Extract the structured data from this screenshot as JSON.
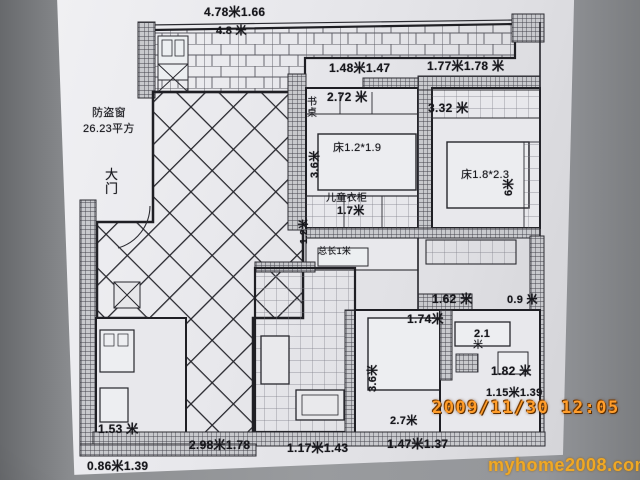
{
  "photo": {
    "datestamp": "2009/11/30 12:05",
    "watermark": "myhome2008.com"
  },
  "colors": {
    "datestamp": "#ff9d2b",
    "watermark": "#f0a824",
    "ink": "#1c1c22",
    "paper": "#e6e6ea",
    "background": "#8d8f92"
  },
  "plan": {
    "annotations": [
      {
        "name": "dim-balcony-top",
        "text": "4.78米1.66",
        "x": 204,
        "y": 6,
        "size": 12,
        "bold": true
      },
      {
        "name": "dim-balcony-inner",
        "text": "4.8 米",
        "x": 216,
        "y": 26,
        "size": 11,
        "bold": true
      },
      {
        "name": "dim-child-window",
        "text": "1.48米1.47",
        "x": 329,
        "y": 62,
        "size": 12,
        "bold": true
      },
      {
        "name": "dim-master-window",
        "text": "1.77米1.78 米",
        "x": 427,
        "y": 60,
        "size": 12,
        "bold": true
      },
      {
        "name": "dim-child-width",
        "text": "2.72 米",
        "x": 327,
        "y": 91,
        "size": 12,
        "bold": true
      },
      {
        "name": "label-desk",
        "text": "书桌",
        "x": 307,
        "y": 98,
        "size": 10,
        "stack": true
      },
      {
        "name": "dim-master-width",
        "text": "3.32 米",
        "x": 428,
        "y": 102,
        "size": 12,
        "bold": true
      },
      {
        "name": "label-child-bed",
        "text": "床1.2*1.9",
        "x": 333,
        "y": 143,
        "size": 11
      },
      {
        "name": "dim-child-depth",
        "text": "3.6米",
        "x": 310,
        "y": 178,
        "size": 11,
        "bold": true,
        "rot": -90
      },
      {
        "name": "label-child-wardrobe",
        "text": "儿童衣柜",
        "x": 326,
        "y": 194,
        "size": 10
      },
      {
        "name": "dim-wardrobe",
        "text": "1.7米",
        "x": 337,
        "y": 206,
        "size": 11,
        "bold": true
      },
      {
        "name": "label-master-bed",
        "text": "床1.8*2.3",
        "x": 461,
        "y": 170,
        "size": 11
      },
      {
        "name": "dim-master-depth",
        "text": "6米",
        "x": 504,
        "y": 196,
        "size": 11,
        "bold": true,
        "rot": -90
      },
      {
        "name": "note-security-window-1",
        "text": "防盗窗",
        "x": 92,
        "y": 108,
        "size": 11
      },
      {
        "name": "note-security-window-2",
        "text": "26.23平方",
        "x": 83,
        "y": 124,
        "size": 11
      },
      {
        "name": "label-main-door",
        "text": "大门",
        "x": 105,
        "y": 168,
        "size": 13,
        "stack": true
      },
      {
        "name": "dim-hall",
        "text": "1.2米",
        "x": 300,
        "y": 244,
        "size": 10,
        "bold": true,
        "rot": -90
      },
      {
        "name": "note-total-length",
        "text": "总长1米",
        "x": 318,
        "y": 247,
        "size": 9
      },
      {
        "name": "dim-kitchen",
        "text": "1.62 米",
        "x": 432,
        "y": 293,
        "size": 12,
        "bold": true
      },
      {
        "name": "dim-kitchen-right",
        "text": "0.9 米",
        "x": 507,
        "y": 295,
        "size": 11,
        "bold": true
      },
      {
        "name": "dim-passage",
        "text": "1.74米",
        "x": 407,
        "y": 313,
        "size": 12,
        "bold": true
      },
      {
        "name": "dim-room-21",
        "text": "2.1",
        "x": 474,
        "y": 329,
        "size": 11,
        "bold": true
      },
      {
        "name": "dim-room-21-unit",
        "text": "米",
        "x": 473,
        "y": 341,
        "size": 10
      },
      {
        "name": "dim-room-182",
        "text": "1.82 米",
        "x": 491,
        "y": 365,
        "size": 12,
        "bold": true
      },
      {
        "name": "dim-room-115",
        "text": "1.15米1.39",
        "x": 486,
        "y": 388,
        "size": 11,
        "bold": true
      },
      {
        "name": "dim-dining-depth",
        "text": "3.6米",
        "x": 368,
        "y": 392,
        "size": 11,
        "bold": true,
        "rot": -90
      },
      {
        "name": "dim-dining",
        "text": "2.7米",
        "x": 390,
        "y": 416,
        "size": 11,
        "bold": true
      },
      {
        "name": "dim-dining-bottom",
        "text": "1.47米1.37",
        "x": 387,
        "y": 438,
        "size": 12,
        "bold": true
      },
      {
        "name": "dim-bath-bottom",
        "text": "1.17米1.43",
        "x": 287,
        "y": 442,
        "size": 12,
        "bold": true
      },
      {
        "name": "dim-living-bottom",
        "text": "2.98米1.78",
        "x": 189,
        "y": 439,
        "size": 12,
        "bold": true
      },
      {
        "name": "dim-left-room",
        "text": "1.53 米",
        "x": 98,
        "y": 423,
        "size": 12,
        "bold": true
      },
      {
        "name": "dim-left-bottom",
        "text": "0.86米1.39",
        "x": 87,
        "y": 460,
        "size": 12,
        "bold": true
      }
    ]
  }
}
